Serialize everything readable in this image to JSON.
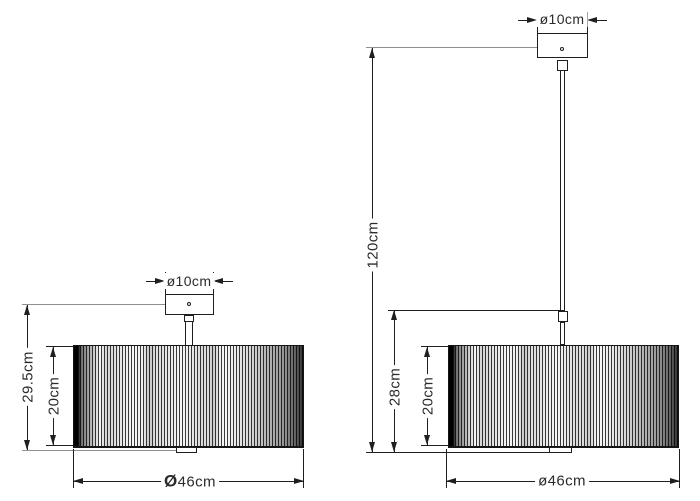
{
  "colors": {
    "line": "#1f1f1f",
    "extension_line": "#909090",
    "text": "#2b2b2b",
    "background": "#ffffff"
  },
  "left_fixture": {
    "canopy_diameter_label": "ø10cm",
    "overall_height_label": "29.5cm",
    "shade_height_label": "20cm",
    "shade_diameter_symbol": "Ø",
    "shade_diameter_value": "46cm"
  },
  "right_fixture": {
    "canopy_diameter_label": "ø10cm",
    "drop_height_label": "120cm",
    "stem_height_label": "28cm",
    "shade_height_label": "20cm",
    "shade_diameter_symbol": "ø",
    "shade_diameter_value": "46cm"
  }
}
